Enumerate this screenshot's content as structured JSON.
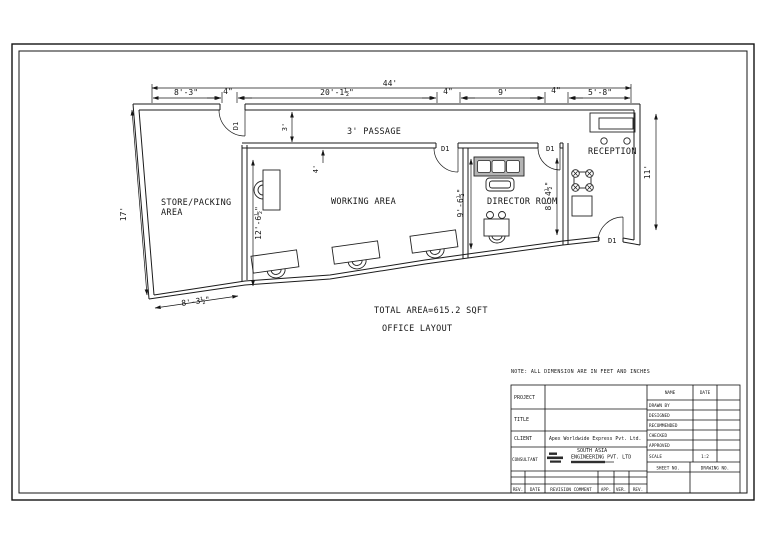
{
  "sheet": {
    "note": "NOTE: ALL DIMENSION ARE IN FEET AND INCHES",
    "total_area": "TOTAL AREA=615.2 SQFT",
    "drawing_title": "OFFICE LAYOUT"
  },
  "plan": {
    "rooms": {
      "store_line1": "STORE/PACKING",
      "store_line2": "AREA",
      "working": "WORKING AREA",
      "passage": "3' PASSAGE",
      "director": "DIRECTOR ROOM",
      "reception": "RECEPTION"
    },
    "door_label": "D1",
    "dims": {
      "overall_top": "44'",
      "top": [
        "8'-3\"",
        "4\"",
        "20'-1½\"",
        "4\"",
        "9'",
        "4\"",
        "5'-8\""
      ],
      "left": "17'",
      "right": "11'",
      "store_bottom": "8'-3½\"",
      "passage_width": "3'",
      "working_top": "4'",
      "working_left": "12'-6½\"",
      "director_left": "9'-6½\"",
      "director_right": "8'-4½\""
    }
  },
  "titleblock": {
    "project_label": "PROJECT",
    "title_label": "TITLE",
    "client_label": "CLIENT",
    "consultant_label": "CONSULTANT",
    "client_value": "Apex Worldwide Express Pvt. Ltd.",
    "consultant_line1": "SOUTH ASIA",
    "consultant_line2": "ENGINEERING PVT. LTD",
    "name_label": "NAME",
    "date_label": "DATE",
    "rows": {
      "drawn_by": "DRAWN BY",
      "designed": "DESIGNED",
      "recommended": "RECOMMENDED",
      "checked": "CHECKED",
      "approved": "APPROVED",
      "scale": "SCALE"
    },
    "scale_value": "1:2",
    "sheet_no_label": "SHEET NO.",
    "drawing_no_label": "DRAWING NO.",
    "revision": {
      "rev": "REV.",
      "date": "DATE",
      "comment": "REVISION COMMENT",
      "app": "APP.",
      "ver": "VER.",
      "rev2": "REV."
    }
  }
}
